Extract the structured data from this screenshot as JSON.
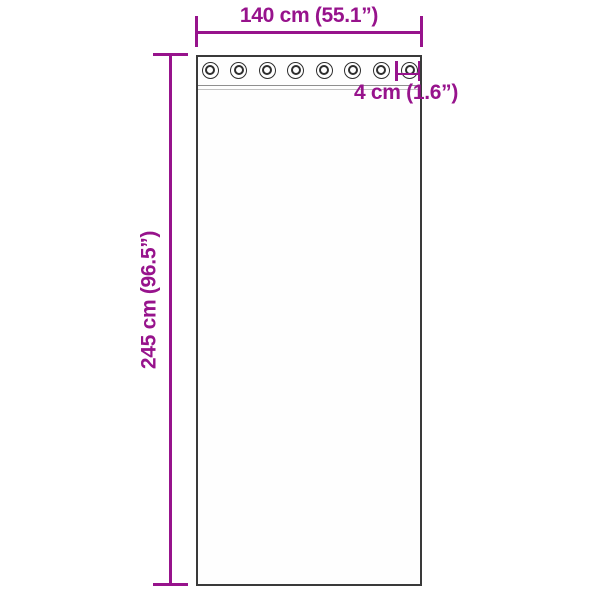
{
  "diagram": {
    "type": "product-dimension-diagram",
    "subject": "curtain panel with grommets",
    "colors": {
      "accent": "#97138C",
      "outline": "#3A3A3A",
      "seam_dark": "#8F8F8F",
      "seam_light": "#C2C2C2",
      "background": "#FFFFFF"
    },
    "dimensions": {
      "width_label": "140 cm (55.1”)",
      "height_label": "245 cm (96.5”)",
      "grommet_label": "4 cm (1.6”)"
    },
    "grommets": {
      "count": 8
    }
  }
}
